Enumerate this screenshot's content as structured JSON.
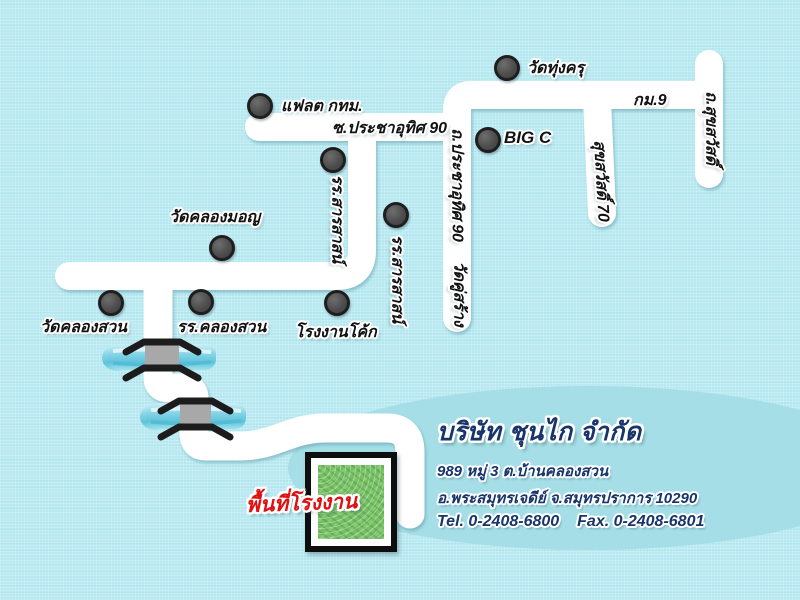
{
  "landmarks": [
    {
      "id": "wat-thung-khru",
      "label": "วัดทุ่งครุ"
    },
    {
      "id": "flat-bangkok",
      "label": "แฟลต กทม."
    },
    {
      "id": "big-c",
      "label": "BIG C"
    },
    {
      "id": "school-sarasas-upper",
      "label": "รร.สารสาสน์"
    },
    {
      "id": "school-sarasas-lower",
      "label": "รร.สารสาสน์"
    },
    {
      "id": "wat-khlong-mon",
      "label": "วัดคลองมอญ"
    },
    {
      "id": "wat-khlong-suan",
      "label": "วัดคลองสวน"
    },
    {
      "id": "school-khlong-suan",
      "label": "รร.คลองสวน"
    },
    {
      "id": "coke-factory",
      "label": "โรงงานโค้ก"
    }
  ],
  "roads": [
    {
      "id": "km9",
      "label": "กม.9"
    },
    {
      "id": "suksawat-road",
      "label": "ถ.สุขสวัสดิ์"
    },
    {
      "id": "suksawat-70",
      "label": "สุขสวัสดิ์ 70"
    },
    {
      "id": "soi-prachauthit-90",
      "label": "ซ.ประชาอุทิศ 90"
    },
    {
      "id": "prachauthit-90-road",
      "label": "ถ.ประชาอุทิศ 90"
    },
    {
      "id": "wat-khu-sang",
      "label": "วัดคู่สร้าง"
    }
  ],
  "factory_area": {
    "label": "พื้นที่โรงงาน"
  },
  "company": {
    "name": "บริษัท ชุนไก จำกัด",
    "address_line1": "989 หมู่ 3 ต.บ้านคลองสวน",
    "address_line2": "อ.พระสมุทรเจดีย์ จ.สมุทรปราการ 10290",
    "tel": "Tel. 0-2408-6800",
    "fax": "Fax. 0-2408-6801"
  },
  "colors": {
    "background": "#b5e8f0",
    "road": "#ffffff",
    "canal": "#8edbe9",
    "marker": "#4d4d4d",
    "factory_green": "#74c062",
    "factory_label_red": "#e01010",
    "company_text_blue": "#17356b",
    "highlight_ellipse": "#a5dee7"
  }
}
